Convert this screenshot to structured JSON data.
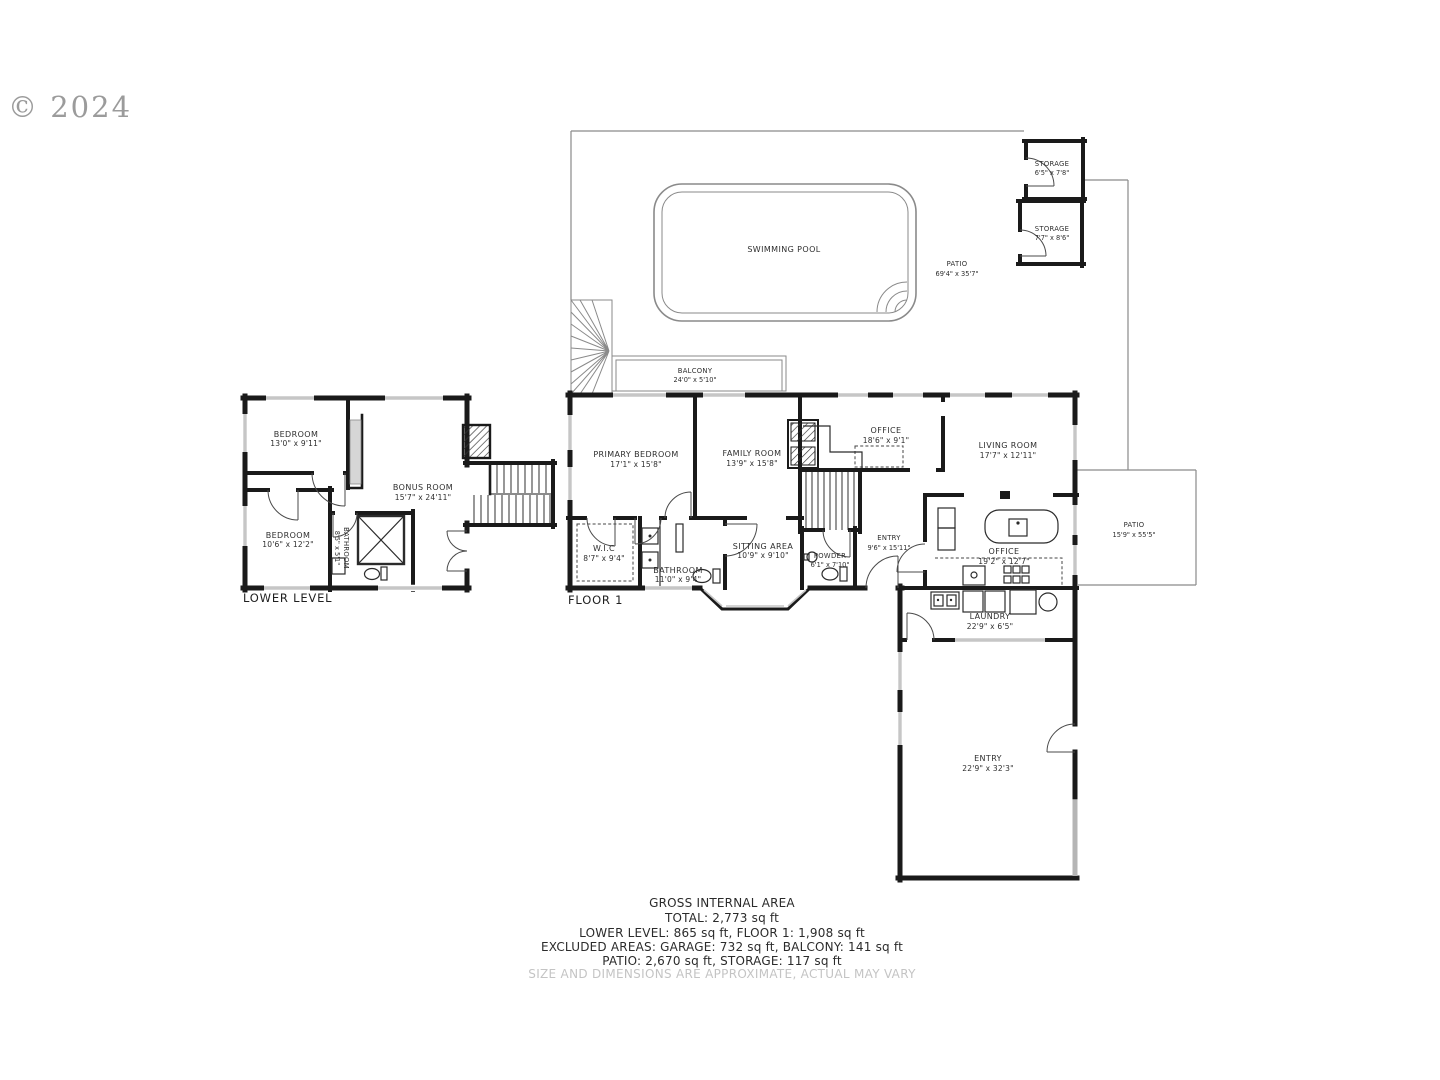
{
  "copyright": "© 2024",
  "floor_labels": {
    "lower_level": "LOWER LEVEL",
    "floor1": "FLOOR 1"
  },
  "outdoor": {
    "swimming_pool": {
      "name": "SWIMMING POOL"
    },
    "patio_top": {
      "name": "PATIO",
      "dims": "69'4\" x 35'7\""
    },
    "patio_right": {
      "name": "PATIO",
      "dims": "15'9\" x 55'5\""
    },
    "balcony": {
      "name": "BALCONY",
      "dims": "24'0\" x 5'10\""
    },
    "storage_upper": {
      "name": "STORAGE",
      "dims": "6'5\" x 7'8\""
    },
    "storage_lower": {
      "name": "STORAGE",
      "dims": "7'7\" x 8'6\""
    }
  },
  "lower_level": {
    "bedroom_top": {
      "name": "BEDROOM",
      "dims": "13'0\" x 9'11\""
    },
    "bedroom_bottom": {
      "name": "BEDROOM",
      "dims": "10'6\" x 12'2\""
    },
    "bathroom": {
      "name": "BATHROOM",
      "dims": "8'5\" x 5'1\""
    },
    "bonus_room": {
      "name": "BONUS ROOM",
      "dims": "15'7\" x 24'11\""
    }
  },
  "floor1": {
    "primary_bedroom": {
      "name": "PRIMARY BEDROOM",
      "dims": "17'1\" x 15'8\""
    },
    "family_room": {
      "name": "FAMILY ROOM",
      "dims": "13'9\" x 15'8\""
    },
    "office_upper": {
      "name": "OFFICE",
      "dims": "18'6\" x 9'1\""
    },
    "living_room": {
      "name": "LIVING ROOM",
      "dims": "17'7\" x 12'11\""
    },
    "wic": {
      "name": "W.I.C",
      "dims": "8'7\" x 9'4\""
    },
    "bathroom": {
      "name": "BATHROOM",
      "dims": "11'0\" x 9'4\""
    },
    "sitting_area": {
      "name": "SITTING AREA",
      "dims": "10'9\" x 9'10\""
    },
    "powder": {
      "name": "POWDER",
      "dims": "6'1\" x 7'10\""
    },
    "entry_hall": {
      "name": "ENTRY",
      "dims": "9'6\" x 15'11\""
    },
    "office_kitchen": {
      "name": "OFFICE",
      "dims": "19'2\" x 12'7\""
    },
    "laundry": {
      "name": "LAUNDRY",
      "dims": "22'9\" x 6'5\""
    },
    "entry_garage": {
      "name": "ENTRY",
      "dims": "22'9\" x 32'3\""
    }
  },
  "footer": {
    "line1": "GROSS INTERNAL AREA",
    "line2": "TOTAL: 2,773 sq ft",
    "line3": "LOWER LEVEL: 865 sq ft, FLOOR 1: 1,908 sq ft",
    "line4": "EXCLUDED AREAS: GARAGE: 732 sq ft, BALCONY: 141 sq ft",
    "line5": "PATIO: 2,670 sq ft, STORAGE: 117 sq ft",
    "disclaimer": "SIZE AND DIMENSIONS ARE APPROXIMATE, ACTUAL MAY VARY"
  },
  "colors": {
    "wall": "#1a1a1a",
    "outdoor_line": "#8a8a8a",
    "text": "#2e2e2e",
    "window": "#c6c6c6",
    "muted": "#c4c4c4",
    "copyright": "#9b9b9b"
  }
}
